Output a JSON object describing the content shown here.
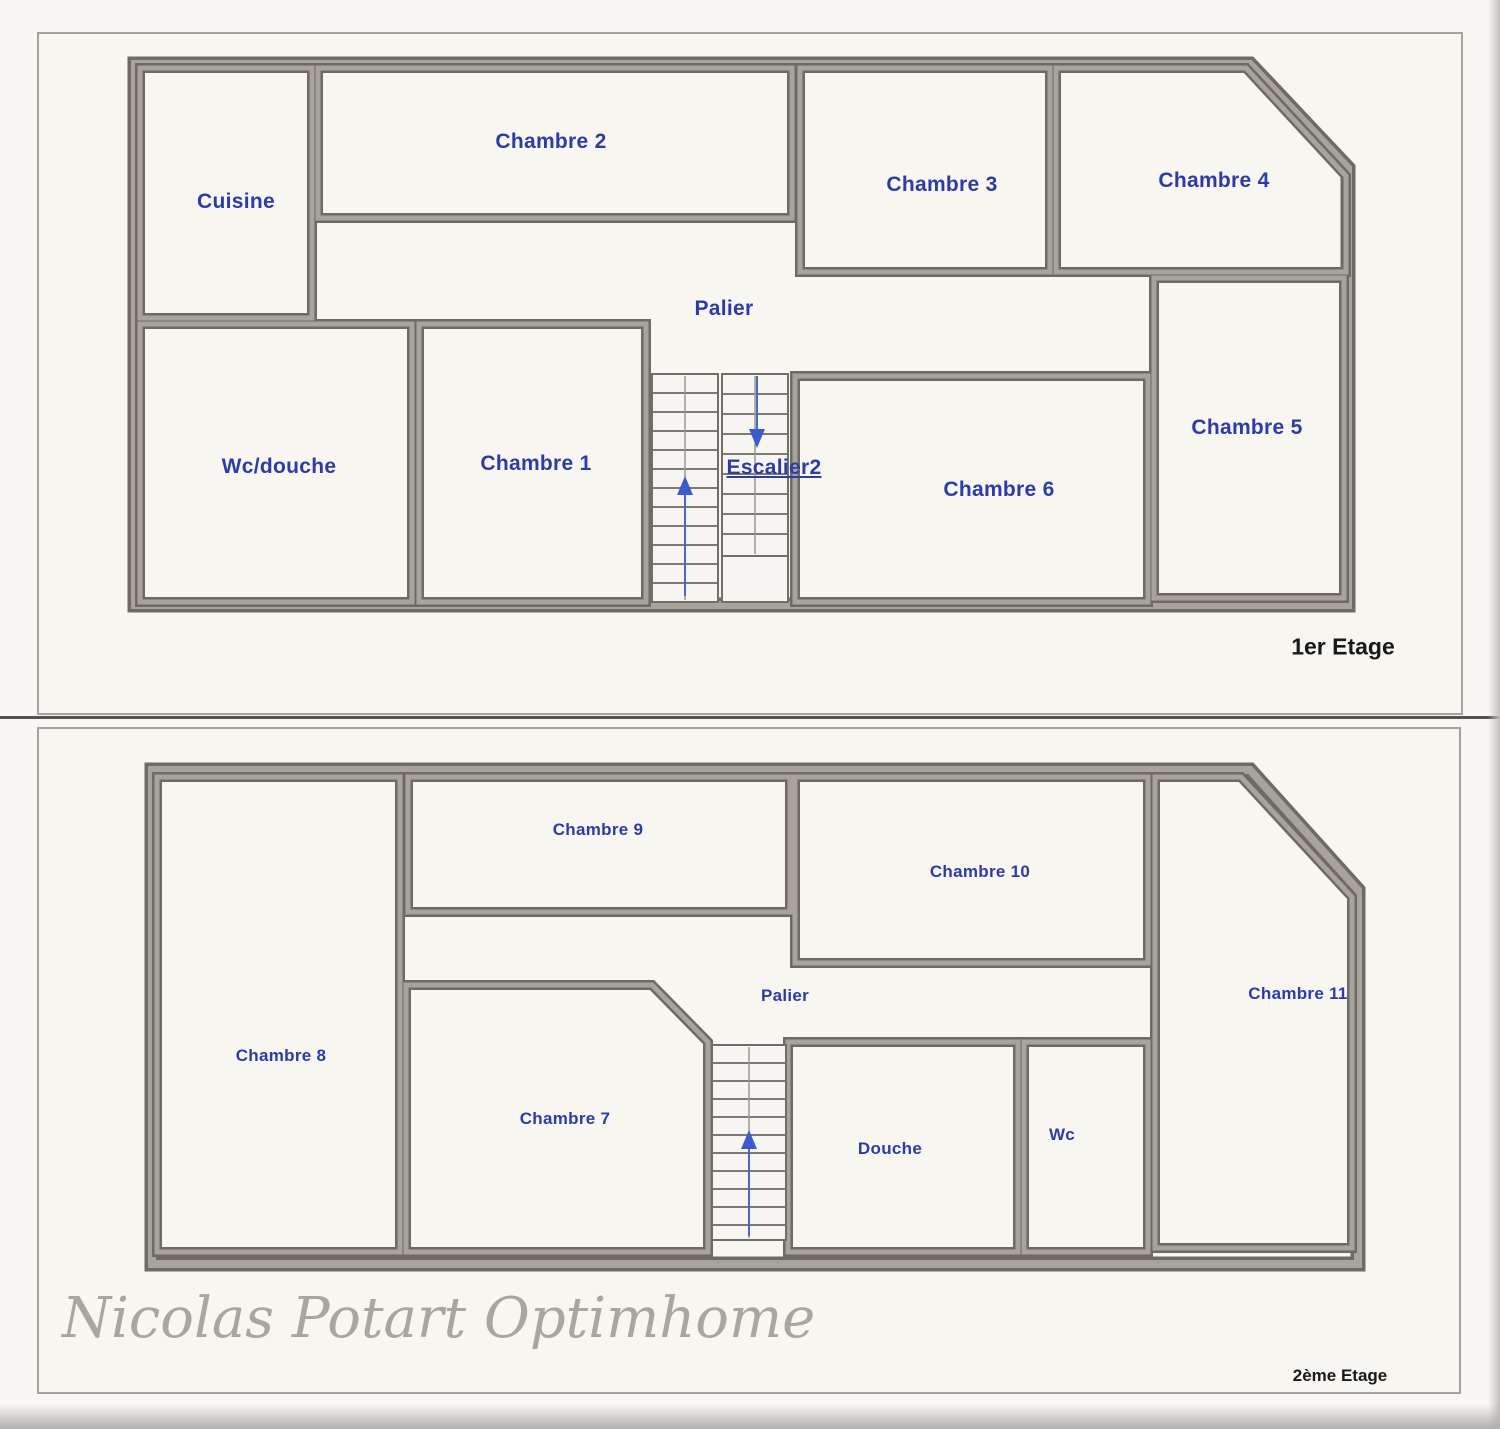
{
  "floor1": {
    "title": "1er Etage",
    "rooms": [
      {
        "name": "cuisine",
        "label": "Cuisine"
      },
      {
        "name": "chambre-2",
        "label": "Chambre 2"
      },
      {
        "name": "chambre-3",
        "label": "Chambre 3"
      },
      {
        "name": "chambre-4",
        "label": "Chambre 4"
      },
      {
        "name": "palier",
        "label": "Palier"
      },
      {
        "name": "wc-douche",
        "label": "Wc/douche"
      },
      {
        "name": "chambre-1",
        "label": "Chambre 1"
      },
      {
        "name": "escalier",
        "label": "Escalier2"
      },
      {
        "name": "chambre-6",
        "label": "Chambre 6"
      },
      {
        "name": "chambre-5",
        "label": "Chambre 5"
      }
    ]
  },
  "floor2": {
    "title": "2ème Etage",
    "rooms": [
      {
        "name": "chambre-8",
        "label": "Chambre 8"
      },
      {
        "name": "chambre-9",
        "label": "Chambre 9"
      },
      {
        "name": "chambre-10",
        "label": "Chambre 10"
      },
      {
        "name": "chambre-11",
        "label": "Chambre 11"
      },
      {
        "name": "palier",
        "label": "Palier"
      },
      {
        "name": "chambre-7",
        "label": "Chambre 7"
      },
      {
        "name": "douche",
        "label": "Douche"
      },
      {
        "name": "wc",
        "label": "Wc"
      }
    ]
  },
  "watermark": "Nicolas Potart Optimhome",
  "icons": {
    "stairs_up_arrow": "up-arrow",
    "stairs_down_arrow": "down-arrow"
  },
  "colors": {
    "room_label_blue": "#2d3ba8",
    "wall_gray": "#8f8b85",
    "wall_edge_dark": "#6e6a64",
    "title_black": "#191919",
    "watermark_gray": "#a8a6a1",
    "page_background": "#f7f6f1",
    "arrow_blue": "#3b5bd0"
  }
}
